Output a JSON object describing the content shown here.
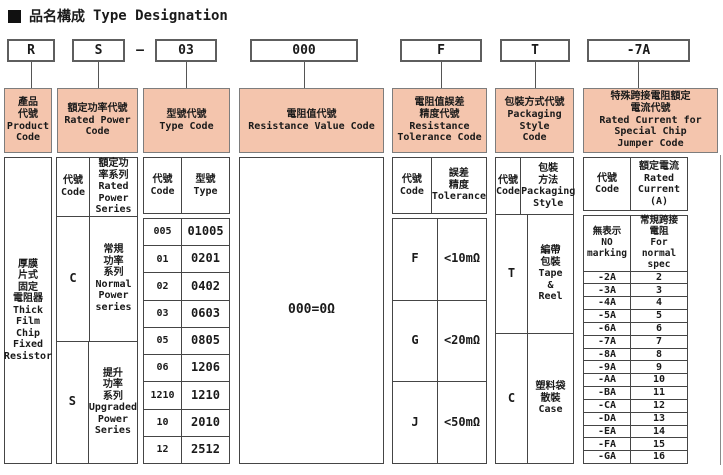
{
  "title": {
    "bullet": "",
    "cjk": "品名構成",
    "en": "Type Designation"
  },
  "top_boxes": {
    "product": "R",
    "power": "S",
    "separator": "—",
    "type": "03",
    "resistance": "000",
    "tolerance": "F",
    "packaging": "T",
    "jumper": "-7A"
  },
  "columns": {
    "product": {
      "header": "產品\n代號\nProduct\nCode",
      "body": "厚膜\n片式\n固定\n電阻器\nThick\nFilm\nChip\nFixed\nResistor"
    },
    "rated_power": {
      "header": "額定功率代號\nRated Power\nCode",
      "sub_code": "代號\nCode",
      "sub_desc": "額定功\n率系列\nRated\nPower\nSeries",
      "rows": [
        {
          "code": "C",
          "desc": "常規\n功率\n系列\nNormal\nPower\nseries"
        },
        {
          "code": "S",
          "desc": "提升\n功率\n系列\nUpgraded\nPower\nSeries"
        }
      ]
    },
    "type_code": {
      "header": "型號代號\nType Code",
      "sub_code": "代號\nCode",
      "sub_type": "型號\nType",
      "rows": [
        {
          "code": "005",
          "type": "01005"
        },
        {
          "code": "01",
          "type": "0201"
        },
        {
          "code": "02",
          "type": "0402"
        },
        {
          "code": "03",
          "type": "0603"
        },
        {
          "code": "05",
          "type": "0805"
        },
        {
          "code": "06",
          "type": "1206"
        },
        {
          "code": "1210",
          "type": "1210"
        },
        {
          "code": "10",
          "type": "2010"
        },
        {
          "code": "12",
          "type": "2512"
        }
      ]
    },
    "resistance_value": {
      "header": "電阻值代號\nResistance Value Code",
      "body": "000=0Ω"
    },
    "tolerance": {
      "header": "電阻值誤差\n精度代號\nResistance\nTolerance Code",
      "sub_code": "代號\nCode",
      "sub_tol": "誤差\n精度\nTolerance",
      "rows": [
        {
          "code": "F",
          "tol": "<10mΩ"
        },
        {
          "code": "G",
          "tol": "<20mΩ"
        },
        {
          "code": "J",
          "tol": "<50mΩ"
        }
      ]
    },
    "packaging": {
      "header": "包裝方式代號\nPackaging Style\nCode",
      "sub_code": "代號\nCode",
      "sub_style": "包裝\n方法\nPackaging\nStyle",
      "rows": [
        {
          "code": "T",
          "style": "編帶\n包裝\nTape\n&\nReel"
        },
        {
          "code": "C",
          "style": "塑料袋\n散裝\nCase"
        }
      ]
    },
    "jumper": {
      "header": "特殊跨接電阻額定\n電流代號\nRated Current for\nSpecial Chip\nJumper Code",
      "sub_code": "代號\nCode",
      "sub_current": "額定電流\nRated\nCurrent\n(A)",
      "special_row": {
        "code": "無表示\nNO\nmarking",
        "current": "常規跨接\n電阻\nFor normal\nspec"
      },
      "rows": [
        {
          "code": "-2A",
          "current": "2"
        },
        {
          "code": "-3A",
          "current": "3"
        },
        {
          "code": "-4A",
          "current": "4"
        },
        {
          "code": "-5A",
          "current": "5"
        },
        {
          "code": "-6A",
          "current": "6"
        },
        {
          "code": "-7A",
          "current": "7"
        },
        {
          "code": "-8A",
          "current": "8"
        },
        {
          "code": "-9A",
          "current": "9"
        },
        {
          "code": "-AA",
          "current": "10"
        },
        {
          "code": "-BA",
          "current": "11"
        },
        {
          "code": "-CA",
          "current": "12"
        },
        {
          "code": "-DA",
          "current": "13"
        },
        {
          "code": "-EA",
          "current": "14"
        },
        {
          "code": "-FA",
          "current": "15"
        },
        {
          "code": "-GA",
          "current": "16"
        }
      ]
    }
  },
  "colors": {
    "header_bg": "#f4c5ad",
    "border": "#454545"
  }
}
